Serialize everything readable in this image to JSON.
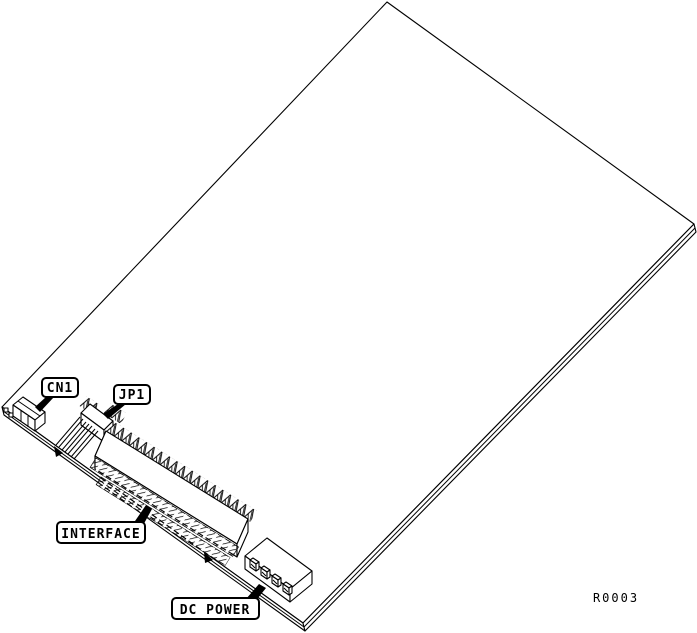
{
  "figure": {
    "background_color": "#ffffff",
    "line_color": "#000000",
    "callouts": [
      {
        "id": "cn1",
        "label": "CN1"
      },
      {
        "id": "jp1",
        "label": "JP1"
      },
      {
        "id": "interface",
        "label": "INTERFACE"
      },
      {
        "id": "dc-power",
        "label": "DC POWER"
      }
    ],
    "reference": "R0003"
  }
}
